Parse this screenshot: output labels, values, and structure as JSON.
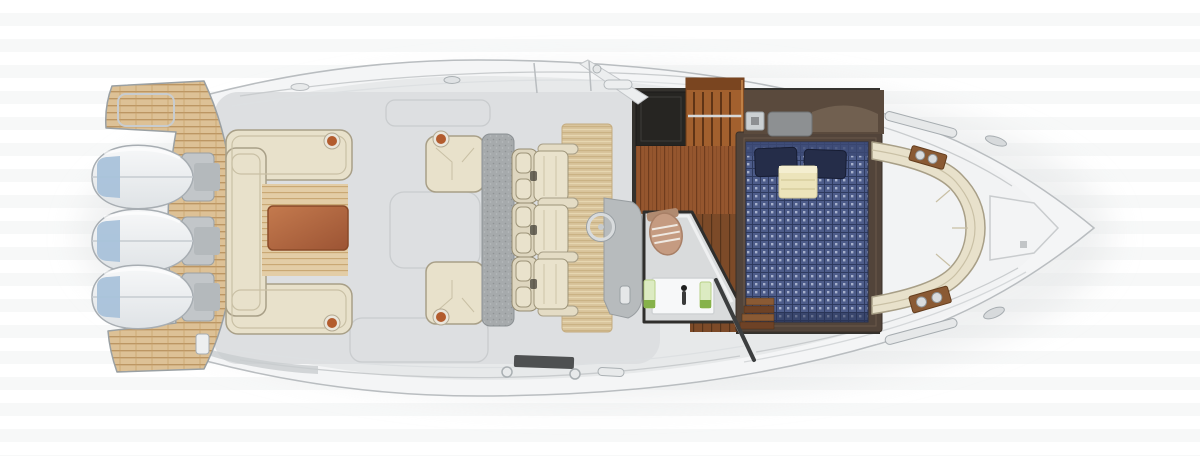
{
  "scene": {
    "type": "yacht-floorplan-top-view",
    "engine_count": 3,
    "helm_seat_count": 3,
    "areas": [
      "swim-platform",
      "outboard-engines",
      "aft-settee",
      "cockpit",
      "side-seats",
      "helm-seats",
      "helm-console",
      "galley-storage",
      "head-compartment",
      "cabin-berth",
      "companionway",
      "bow-lounge",
      "anchor-locker"
    ]
  },
  "colors": {
    "halo": "#e3e5e6",
    "hull": "#f4f5f6",
    "hull_stroke": "#b9bdc0",
    "deck": "#e7e9ea",
    "cockpit_floor": "#dddfe1",
    "bow_deck": "#f2f3f4",
    "seam": "#c9ccce",
    "teak": "#ddc196",
    "teak_line": "#bb9360",
    "teak_edge": "#9aa0a3",
    "engine_body_top": "#f7f8f9",
    "engine_body_bottom": "#dfe3e6",
    "engine_stroke": "#a7adb2",
    "engine_blue": "#a9c2da",
    "engine_mount": "#c2c6c9",
    "upholstery_cream": "#e8e1cb",
    "upholstery_stroke": "#a89f87",
    "upholstery_seam": "#c9c0a5",
    "bench_gray": "#a6aaac",
    "bench_dot": "#8f9395",
    "mat_tan": "#d9c49c",
    "mat_line": "#c9b183",
    "table_wood_light": "#c47a4e",
    "table_wood_dark": "#9c5434",
    "console_gray": "#b7bbbd",
    "wheel_silver": "#d8dbdd",
    "latch_orange": "#b35c2e",
    "cutaway_wall": "#34322e",
    "storage_dark": "#262522",
    "cabinet_wood": "#a2602e",
    "cabinet_slat": "#5f3416",
    "galley_wood": "#95562e",
    "galley_wood_line": "#6f3c1d",
    "walkway_wood": "#7c4a28",
    "walkway_wood_line": "#56331a",
    "headboard_wood": "#5a4a3d",
    "head_floor": "#d9dbdc",
    "head_wall": "#2f2e2c",
    "toilet_tan": "#c59b81",
    "sink_white": "#f7f8f9",
    "towel_green": "#dcebc2",
    "towel_green_accent": "#86b24a",
    "bed_frame_wood": "#52443a",
    "bed_navy": "#4d5c8a",
    "bed_grid_navy": "#2e3a5e",
    "bed_dot": "#a7b1cc",
    "pillow_navy": "#252d49",
    "blanket_cream": "#ece4bb",
    "step_pad_dark": "#4e5051",
    "rail_dark": "#3c3e3f",
    "metal_silver": "#d9dcde"
  }
}
